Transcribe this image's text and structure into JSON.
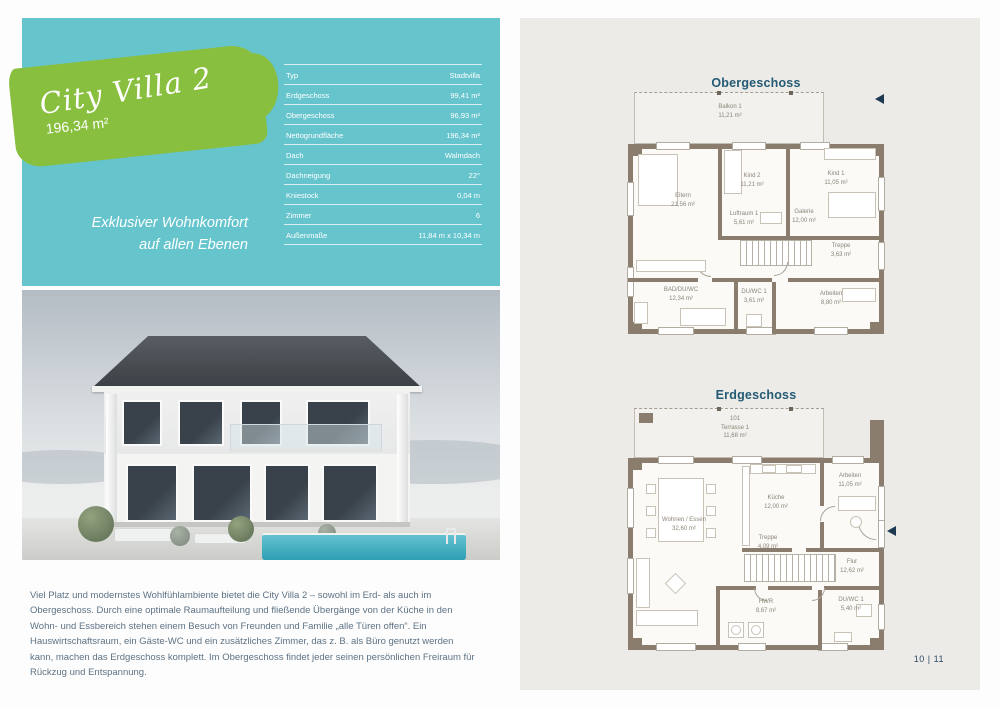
{
  "page": {
    "page_number": "10 | 11"
  },
  "colors": {
    "teal_panel": "#66c4cd",
    "brush_green": "#89bf3e",
    "title_navy": "#245a74",
    "wall_brown": "#8a7d6e",
    "panel_gray": "#ecebe8",
    "pool_turquoise": "#2e9fb4"
  },
  "info_panel": {
    "title": "City Villa 2",
    "living_area": "196,34 m²",
    "tagline_line1": "Exklusiver Wohnkomfort",
    "tagline_line2": "auf allen Ebenen",
    "specs": [
      {
        "label": "Typ",
        "value": "Stadtvilla"
      },
      {
        "label": "Erdgeschoss",
        "value": "99,41 m²"
      },
      {
        "label": "Obergeschoss",
        "value": "96,93 m²"
      },
      {
        "label": "Nettogrundfläche",
        "value": "196,34 m²"
      },
      {
        "label": "Dach",
        "value": "Walmdach"
      },
      {
        "label": "Dachneigung",
        "value": "22°"
      },
      {
        "label": "Kniestock",
        "value": "0,04 m"
      },
      {
        "label": "Zimmer",
        "value": "6"
      },
      {
        "label": "Außenmaße",
        "value": "11,84 m x 10,34 m"
      }
    ]
  },
  "description": "Viel Platz und modernstes Wohlfühlambiente bietet die City Villa 2 – sowohl im Erd- als auch im Obergeschoss. Durch eine optimale Raumaufteilung und fließende Übergänge von der Küche in den Wohn- und Essbereich stehen einem Besuch von Freunden und Familie „alle Türen offen“. Ein Hauswirtschaftsraum, ein Gäste-WC und ein zusätzliches Zimmer, das z. B. als Büro genutzt werden kann, machen das Erdgeschoss komplett. Im Obergeschoss findet jeder seinen persönlichen Freiraum für Rückzug und Entspannung.",
  "plans": {
    "og": {
      "title": "Obergeschoss",
      "rooms": [
        {
          "name": "Balkon 1",
          "area": "11,21 m²"
        },
        {
          "name": "Eltern",
          "area": "21,56 m²"
        },
        {
          "name": "Kind 2",
          "area": "11,21 m²"
        },
        {
          "name": "Kind 1",
          "area": "11,05 m²"
        },
        {
          "name": "Luftraum 1",
          "area": "5,61 m²"
        },
        {
          "name": "Galerie",
          "area": "12,00 m²"
        },
        {
          "name": "Treppe",
          "area": "3,63 m²"
        },
        {
          "name": "BAD/DU/WC",
          "area": "12,34 m²"
        },
        {
          "name": "DU/WC 1",
          "area": "3,61 m²"
        },
        {
          "name": "Arbeiten",
          "area": "8,80 m²"
        }
      ]
    },
    "eg": {
      "title": "Erdgeschoss",
      "rooms": [
        {
          "code": "101",
          "name": "Terrasse 1",
          "area": "11,68 m²"
        },
        {
          "name": "Wohnen / Essen",
          "area": "32,60 m²"
        },
        {
          "name": "Küche",
          "area": "12,00 m²"
        },
        {
          "name": "Arbeiten",
          "area": "11,05 m²"
        },
        {
          "name": "Flur",
          "area": "12,62 m²"
        },
        {
          "name": "Treppe",
          "area": "4,09 m²"
        },
        {
          "name": "HWR",
          "area": "8,67 m²"
        },
        {
          "name": "DU/WC 1",
          "area": "5,40 m²"
        }
      ]
    }
  }
}
